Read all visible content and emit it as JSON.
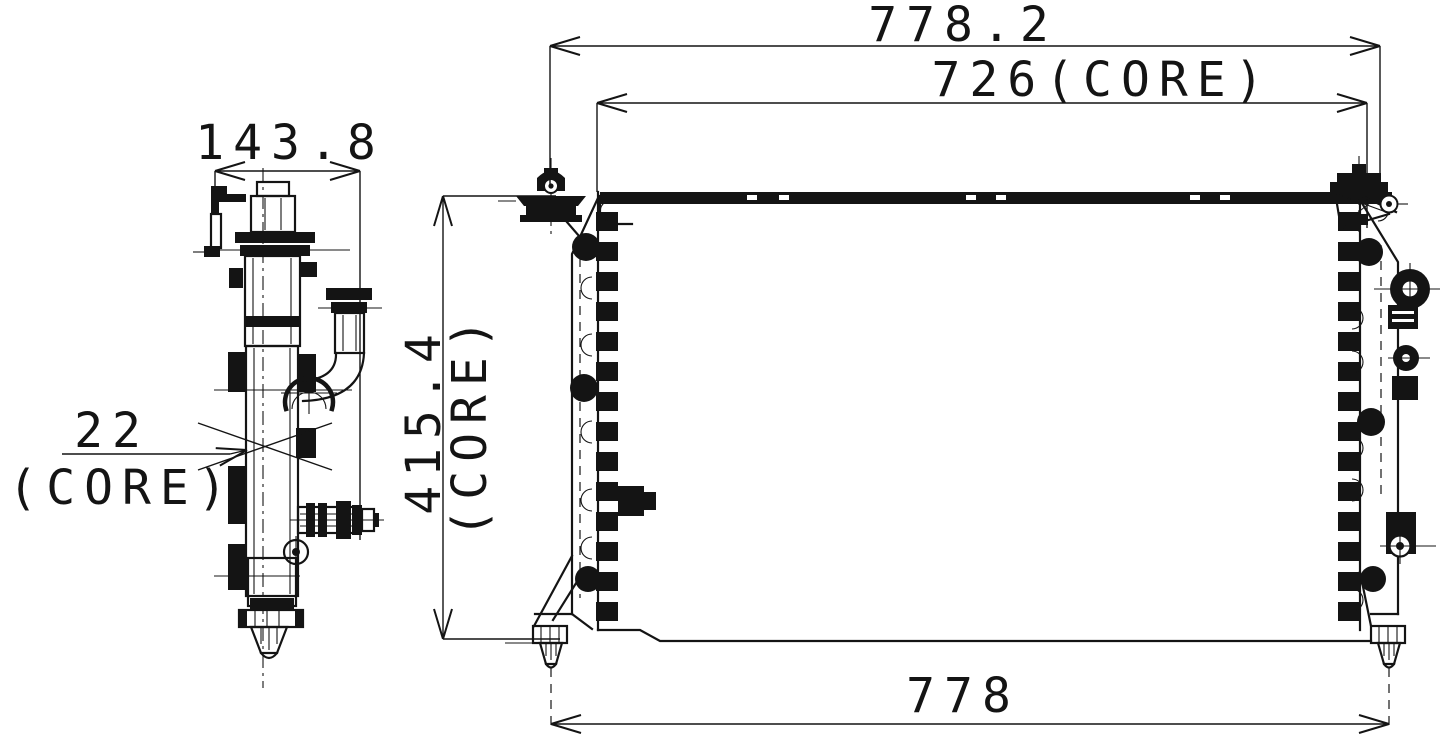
{
  "page": {
    "background": "#ffffff",
    "ink": "#141414"
  },
  "dimensions": {
    "overall_width": {
      "value": "778.2"
    },
    "core_width": {
      "value": "726(CORE)"
    },
    "overall_depth": {
      "value": "143.8"
    },
    "core_thickness": {
      "value": "22",
      "qualifier": "(CORE)"
    },
    "core_height": {
      "value": "415.4",
      "qualifier": "(CORE)"
    },
    "mount_span": {
      "value": "778"
    }
  }
}
